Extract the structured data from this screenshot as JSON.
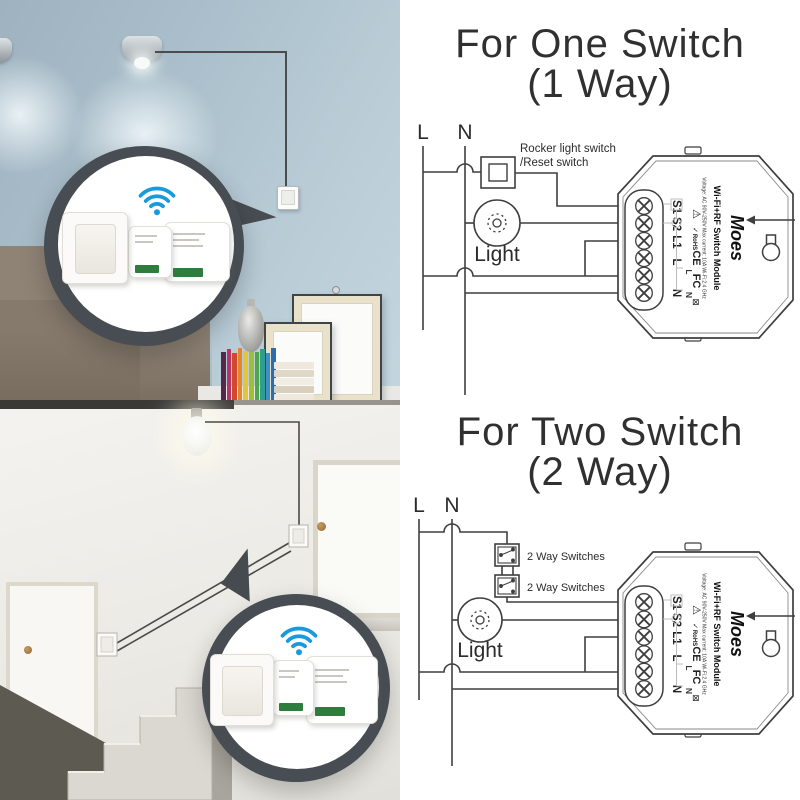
{
  "titles": {
    "one": {
      "line1": "For One Switch",
      "line2": "(1 Way)"
    },
    "two": {
      "line1": "For Two Switch",
      "line2": "(2 Way)"
    }
  },
  "diagram_one": {
    "l_label": "L",
    "n_label": "N",
    "switch_note_line1": "Rocker light switch",
    "switch_note_line2": "/Reset switch",
    "light_label": "Light"
  },
  "diagram_two": {
    "l_label": "L",
    "n_label": "N",
    "switch1_label": "2 Way Switches",
    "switch2_label": "2 Way Switches",
    "light_label": "Light"
  },
  "module": {
    "brand": "Moes",
    "name": "Wi-Fi+RF Switch Module",
    "specs": "Voltage: AC 90V-250V  Max current: 10A  Wi-Fi:2.4 GHz",
    "terminals": [
      "S1",
      "S2",
      "L1",
      "L",
      "N"
    ],
    "inner_labels": {
      "l": "L",
      "n": "N"
    },
    "cert_marks": {
      "warning": "⚠",
      "check": "✓",
      "rohs": "RoHS",
      "ce": "CE",
      "fcc": "FC",
      "weee": "⊠"
    }
  },
  "icons": {
    "wifi_color": "#189add"
  },
  "colors": {
    "diagram_ink": "#3f3f3f",
    "title_text": "#303030",
    "callout_ring": "#474d52",
    "wall_blue": "#aabfcb",
    "sofa_taupe": "#8f8375",
    "terminal_green": "#2e7d3c"
  }
}
